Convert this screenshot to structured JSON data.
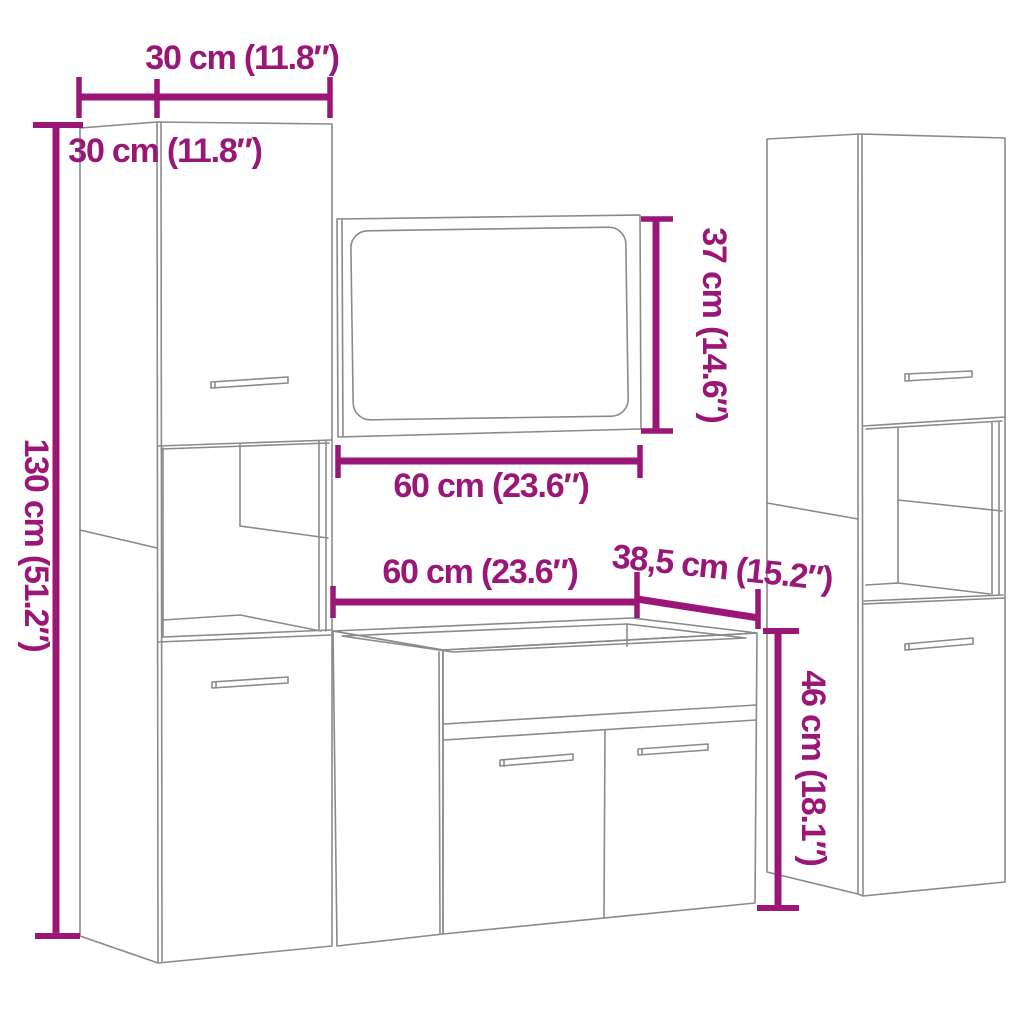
{
  "colors": {
    "accent": "#9a1777",
    "outline": "#8a8a8a",
    "background": "#ffffff"
  },
  "diagram": {
    "type": "furniture-dimension-drawing",
    "pieces": [
      "left-tall-cabinet",
      "wall-mirror",
      "vanity-sink-cabinet",
      "right-tall-cabinet"
    ]
  },
  "labels": {
    "left_cabinet_width": "30 cm (11.8″)",
    "left_cabinet_depth": "30 cm (11.8″)",
    "left_cabinet_height": "130 cm (51.2″)",
    "mirror_width": "60 cm (23.6″)",
    "mirror_height": "37 cm (14.6″)",
    "vanity_width": "60 cm (23.6″)",
    "vanity_depth": "38,5 cm (15.2″)",
    "vanity_height": "46 cm (18.1″)"
  }
}
